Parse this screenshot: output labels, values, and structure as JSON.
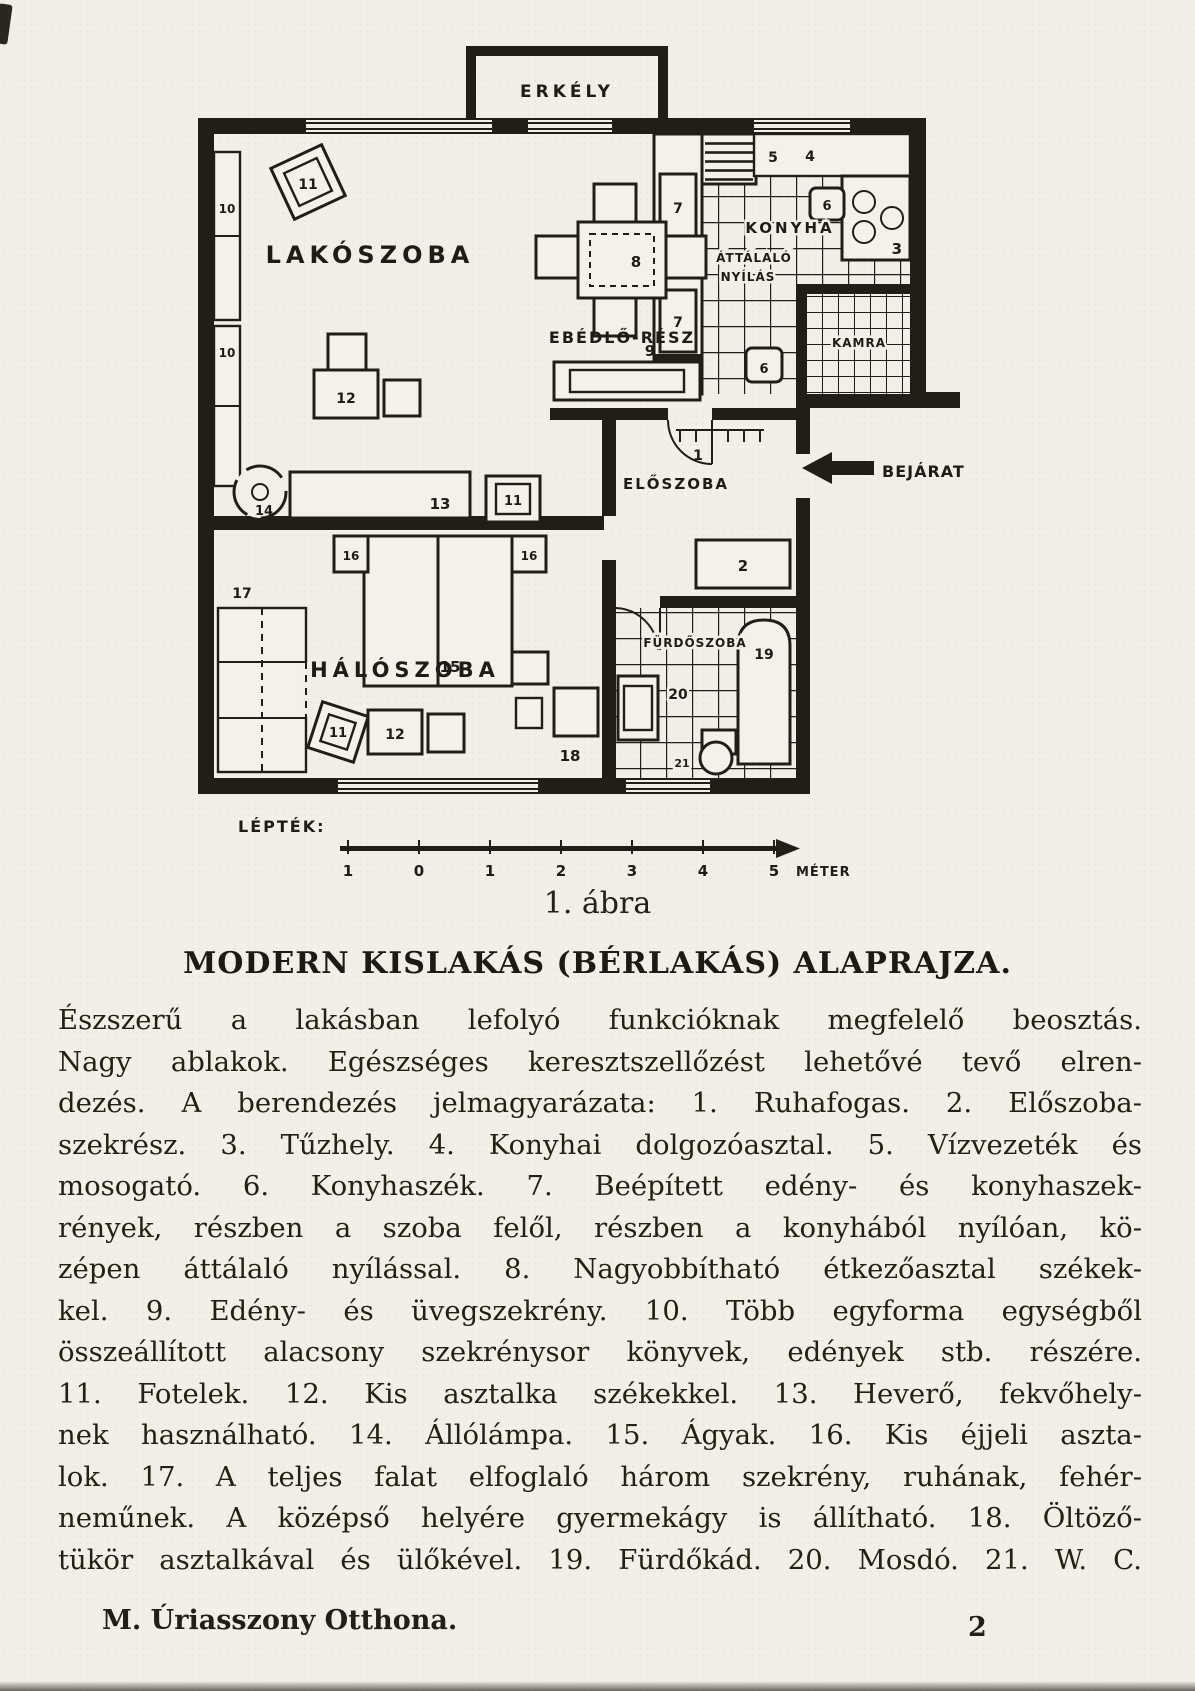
{
  "page": {
    "caption": "1. ábra",
    "title": "MODERN KISLAKÁS (BÉRLAKÁS) ALAPRAJZA.",
    "body": "Észszerű a lakásban lefolyó funkcióknak megfelelő beosztás.\nNagy ablakok. Egészséges keresztszellőzést lehetővé tevő elren-\ndezés. A berendezés jelmagyarázata: 1. Ruhafogas. 2. Előszoba-\nszekrész. 3. Tűzhely. 4. Konyhai dolgozóasztal. 5. Vízvezeték és\nmosogató. 6. Konyhaszék. 7. Beépített edény- és konyhaszek-\nrények, részben a szoba felől, részben a konyhából nyílóan, kö-\nzépen áttálaló nyílással. 8. Nagyobbítható étkezőasztal székek-\nkel. 9. Edény- és üvegszekrény. 10. Több egyforma egységből\nösszeállított alacsony szekrénysor könyvek, edények stb. részére.\n11. Fotelek. 12. Kis asztalka székekkel. 13. Heverő, fekvőhely-\nnek használható. 14. Állólámpa. 15. Ágyak. 16. Kis éjjeli aszta-\nlok. 17. A teljes falat elfoglaló három szekrény, ruhának, fehér-\nneműnek. A középső helyére gyermekágy is állítható. 18. Öltöző-\ntükör asztalkával és ülőkével. 19. Fürdőkád. 20. Mosdó. 21. W. C.",
    "footer_left": "M. Úriasszony Otthona.",
    "footer_page": "2"
  },
  "plan": {
    "markers": [
      {
        "t": "ERKÉLY",
        "x": 369,
        "y": 57,
        "fs": 17,
        "anchor": "middle",
        "ls": 4,
        "name": "room-label-balcony"
      },
      {
        "t": "LAKÓSZOBA",
        "x": 172,
        "y": 223,
        "fs": 24,
        "anchor": "middle",
        "ls": 5,
        "name": "room-label-living"
      },
      {
        "t": "EBÉDLŐ-RÉSZ",
        "x": 424,
        "y": 303,
        "fs": 16,
        "anchor": "middle",
        "ls": 2,
        "name": "room-label-dining"
      },
      {
        "t": "KONYHA",
        "x": 592,
        "y": 193,
        "fs": 15,
        "anchor": "middle",
        "ls": 3,
        "halo": true,
        "name": "room-label-kitchen"
      },
      {
        "t": "ÁTTÁLALÓ",
        "x": 556,
        "y": 222,
        "fs": 12,
        "anchor": "middle",
        "ls": 1,
        "halo": true,
        "name": "hatch-label-line1"
      },
      {
        "t": "NYÍLÁS",
        "x": 550,
        "y": 241,
        "fs": 12,
        "anchor": "middle",
        "ls": 1,
        "halo": true,
        "name": "hatch-label-line2"
      },
      {
        "t": "KAMRA",
        "x": 661,
        "y": 307,
        "fs": 12,
        "anchor": "middle",
        "ls": 1,
        "halo": true,
        "name": "room-label-pantry"
      },
      {
        "t": "ELŐSZOBA",
        "x": 478,
        "y": 449,
        "fs": 15,
        "anchor": "middle",
        "ls": 2,
        "name": "room-label-hall"
      },
      {
        "t": "HÁLÓSZOBA",
        "x": 207,
        "y": 637,
        "fs": 21,
        "anchor": "middle",
        "ls": 5,
        "name": "room-label-bedroom"
      },
      {
        "t": "FÜRDŐSZOBA",
        "x": 497,
        "y": 607,
        "fs": 12,
        "anchor": "middle",
        "ls": 1,
        "halo": true,
        "name": "room-label-bathroom"
      },
      {
        "t": "BEJÁRAT",
        "x": 684,
        "y": 437,
        "fs": 16,
        "anchor": "start",
        "ls": 1,
        "name": "entrance-label"
      },
      {
        "t": "LÉPTÉK:",
        "x": 40,
        "y": 792,
        "fs": 16,
        "anchor": "start",
        "ls": 2,
        "name": "scale-label"
      },
      {
        "t": "1",
        "x": 150,
        "y": 836,
        "fs": 15,
        "anchor": "middle",
        "name": "scale-num"
      },
      {
        "t": "0",
        "x": 221,
        "y": 836,
        "fs": 15,
        "anchor": "middle",
        "name": "scale-num"
      },
      {
        "t": "1",
        "x": 292,
        "y": 836,
        "fs": 15,
        "anchor": "middle",
        "name": "scale-num"
      },
      {
        "t": "2",
        "x": 363,
        "y": 836,
        "fs": 15,
        "anchor": "middle",
        "name": "scale-num"
      },
      {
        "t": "3",
        "x": 434,
        "y": 836,
        "fs": 15,
        "anchor": "middle",
        "name": "scale-num"
      },
      {
        "t": "4",
        "x": 505,
        "y": 836,
        "fs": 15,
        "anchor": "middle",
        "name": "scale-num"
      },
      {
        "t": "5",
        "x": 576,
        "y": 836,
        "fs": 15,
        "anchor": "middle",
        "name": "scale-num"
      },
      {
        "t": "MÉTER",
        "x": 598,
        "y": 836,
        "fs": 13,
        "anchor": "start",
        "ls": 1,
        "name": "scale-unit"
      },
      {
        "t": "11",
        "x": 110,
        "y": 149,
        "fs": 14,
        "anchor": "middle",
        "name": "item-11-armchair"
      },
      {
        "t": "10",
        "x": 29,
        "y": 173,
        "fs": 12,
        "anchor": "middle",
        "name": "item-10-cabinet"
      },
      {
        "t": "10",
        "x": 29,
        "y": 317,
        "fs": 12,
        "anchor": "middle",
        "name": "item-10-cabinet"
      },
      {
        "t": "12",
        "x": 148,
        "y": 363,
        "fs": 14,
        "anchor": "middle",
        "name": "item-12-table"
      },
      {
        "t": "13",
        "x": 242,
        "y": 469,
        "fs": 15,
        "anchor": "middle",
        "name": "item-13-divan"
      },
      {
        "t": "11",
        "x": 315,
        "y": 465,
        "fs": 13,
        "anchor": "middle",
        "name": "item-11-armchair"
      },
      {
        "t": "14",
        "x": 66,
        "y": 475,
        "fs": 13,
        "anchor": "middle",
        "name": "item-14-lamp"
      },
      {
        "t": "8",
        "x": 438,
        "y": 227,
        "fs": 15,
        "anchor": "middle",
        "name": "item-8-dining-table"
      },
      {
        "t": "9",
        "x": 452,
        "y": 316,
        "fs": 15,
        "anchor": "middle",
        "name": "item-9-cabinet"
      },
      {
        "t": "7",
        "x": 480,
        "y": 173,
        "fs": 14,
        "anchor": "middle",
        "name": "item-7-cupboard"
      },
      {
        "t": "7",
        "x": 480,
        "y": 287,
        "fs": 14,
        "anchor": "middle",
        "name": "item-7-cupboard"
      },
      {
        "t": "5",
        "x": 575,
        "y": 122,
        "fs": 14,
        "anchor": "middle",
        "name": "item-5-sink"
      },
      {
        "t": "4",
        "x": 612,
        "y": 121,
        "fs": 14,
        "anchor": "middle",
        "name": "item-4-worktable"
      },
      {
        "t": "3",
        "x": 704,
        "y": 214,
        "fs": 15,
        "anchor": "end",
        "name": "item-3-stove"
      },
      {
        "t": "6",
        "x": 629,
        "y": 170,
        "fs": 13,
        "anchor": "middle",
        "name": "item-6-chair"
      },
      {
        "t": "6",
        "x": 566,
        "y": 333,
        "fs": 13,
        "anchor": "middle",
        "name": "item-6-chair"
      },
      {
        "t": "1",
        "x": 500,
        "y": 420,
        "fs": 14,
        "anchor": "middle",
        "name": "item-1-coatrack"
      },
      {
        "t": "2",
        "x": 545,
        "y": 531,
        "fs": 15,
        "anchor": "middle",
        "name": "item-2-hall-closet"
      },
      {
        "t": "16",
        "x": 153,
        "y": 520,
        "fs": 12,
        "anchor": "middle",
        "name": "item-16-nighttable"
      },
      {
        "t": "16",
        "x": 331,
        "y": 520,
        "fs": 12,
        "anchor": "middle",
        "name": "item-16-nighttable"
      },
      {
        "t": "15",
        "x": 252,
        "y": 632,
        "fs": 15,
        "anchor": "middle",
        "name": "item-15-beds"
      },
      {
        "t": "17",
        "x": 44,
        "y": 558,
        "fs": 14,
        "anchor": "middle",
        "name": "item-17-wardrobe"
      },
      {
        "t": "11",
        "x": 140,
        "y": 697,
        "fs": 13,
        "anchor": "middle",
        "name": "item-11-armchair"
      },
      {
        "t": "12",
        "x": 197,
        "y": 699,
        "fs": 14,
        "anchor": "middle",
        "name": "item-12-table"
      },
      {
        "t": "18",
        "x": 372,
        "y": 721,
        "fs": 15,
        "anchor": "middle",
        "name": "item-18-mirror"
      },
      {
        "t": "19",
        "x": 566,
        "y": 619,
        "fs": 14,
        "anchor": "middle",
        "name": "item-19-bathtub"
      },
      {
        "t": "20",
        "x": 480,
        "y": 659,
        "fs": 14,
        "anchor": "middle",
        "halo": true,
        "name": "item-20-washbasin"
      },
      {
        "t": "21",
        "x": 484,
        "y": 727,
        "fs": 11,
        "anchor": "middle",
        "halo": true,
        "name": "item-21-wc"
      }
    ]
  }
}
